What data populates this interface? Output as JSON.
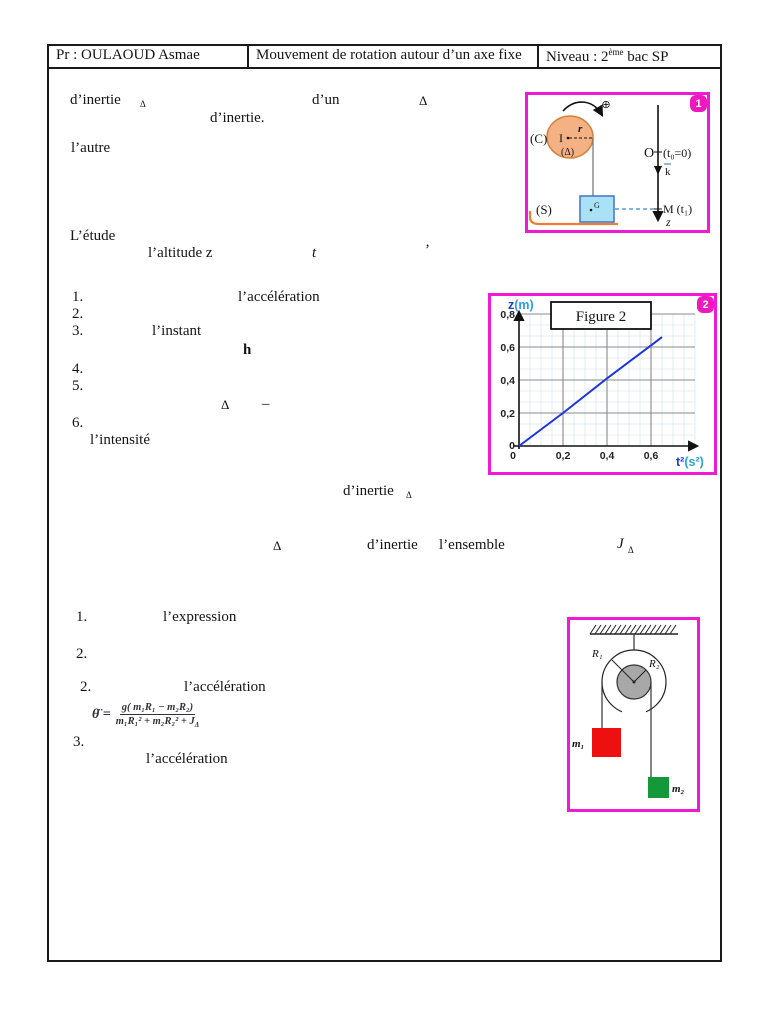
{
  "header": {
    "teacher": "Pr : OULAOUD Asmae",
    "title": "Mouvement de rotation autour d’un axe fixe",
    "level_pre": "Niveau : 2",
    "level_sup": "ème",
    "level_post": " bac SP"
  },
  "fragments": [
    {
      "t": "d’inertie"
    },
    {
      "t": "Δ"
    },
    {
      "t": "d’un"
    },
    {
      "t": "Δ"
    },
    {
      "t": "d’inertie."
    },
    {
      "t": "l’autre"
    },
    {
      "t": "L’étude"
    },
    {
      "t": "l’altitude z"
    },
    {
      "t": "t"
    },
    {
      "t": "’"
    },
    {
      "t": "1."
    },
    {
      "t": "l’accélération"
    },
    {
      "t": "2."
    },
    {
      "t": "3."
    },
    {
      "t": "l’instant"
    },
    {
      "t": "h"
    },
    {
      "t": "4."
    },
    {
      "t": "5."
    },
    {
      "t": "Δ"
    },
    {
      "t": "–"
    },
    {
      "t": "6."
    },
    {
      "t": "l’intensité"
    },
    {
      "t": "d’inertie"
    },
    {
      "t": "Δ"
    },
    {
      "t": "Δ"
    },
    {
      "t": "d’inertie"
    },
    {
      "t": "l’ensemble"
    },
    {
      "t": "J"
    },
    {
      "t": "Δ"
    },
    {
      "t": "1."
    },
    {
      "t": "l’expression"
    },
    {
      "t": "2."
    },
    {
      "t": "2."
    },
    {
      "t": "l’accélération"
    },
    {
      "t": "3."
    },
    {
      "t": "l’accélération"
    }
  ],
  "formula": {
    "lhs": "θ̈ =",
    "numerator": "g( m₁R₁ − m₂R₂)",
    "den_main": "m₁R₁² + m₂R₂² + J",
    "den_sub": "Δ"
  },
  "figure1": {
    "badge": "1",
    "labels": {
      "c": "(C)",
      "i": "I",
      "r": "r",
      "delta": "(Δ)",
      "plus": "⊕",
      "s": "(S)",
      "g": "G",
      "o": "O",
      "t0": "(t₀=0)",
      "k": "k",
      "m": "M (t₁)",
      "z": "z"
    }
  },
  "chart_data": {
    "type": "line",
    "title": "Figure 2",
    "badge": "2",
    "xlabel": "t²(s²)",
    "ylabel": "z(m)",
    "xlabel_sym": "t²",
    "xlabel_unit": "(s²)",
    "ylabel_sym": "z",
    "ylabel_unit": "(m)",
    "x_ticks": [
      "0",
      "0,2",
      "0,4",
      "0,6"
    ],
    "y_ticks": [
      "0",
      "0,2",
      "0,4",
      "0,6",
      "0,8"
    ],
    "xlim": [
      0,
      0.8
    ],
    "ylim": [
      0,
      0.8
    ],
    "grid": true,
    "legend": false,
    "series": [
      {
        "name": "z en fonction de t²",
        "x": [
          0,
          0.2,
          0.4,
          0.6,
          0.65
        ],
        "y": [
          0,
          0.2,
          0.41,
          0.61,
          0.66
        ]
      }
    ],
    "line_color": "#1c35e0"
  },
  "figure3": {
    "labels": {
      "r1": "R₁",
      "r2": "R₂",
      "m1": "m₁",
      "m2": "m₂"
    }
  },
  "colors": {
    "figure_border": "#f01ad6",
    "badge": "#ee18c0",
    "pulley_fill": "#f4b183",
    "pulley_stroke": "#d2813c",
    "mass_fill": "#a9e2f6",
    "mass_stroke": "#4472c4",
    "red_mass": "#ee1010",
    "green_mass": "#13983a",
    "inner_pulley": "#a8a8a8",
    "chart_line": "#1c35e0",
    "axis_blue": "#1b3fd0",
    "axis_cyan": "#2aa0dc",
    "bracket_orange": "#ed7d31"
  }
}
